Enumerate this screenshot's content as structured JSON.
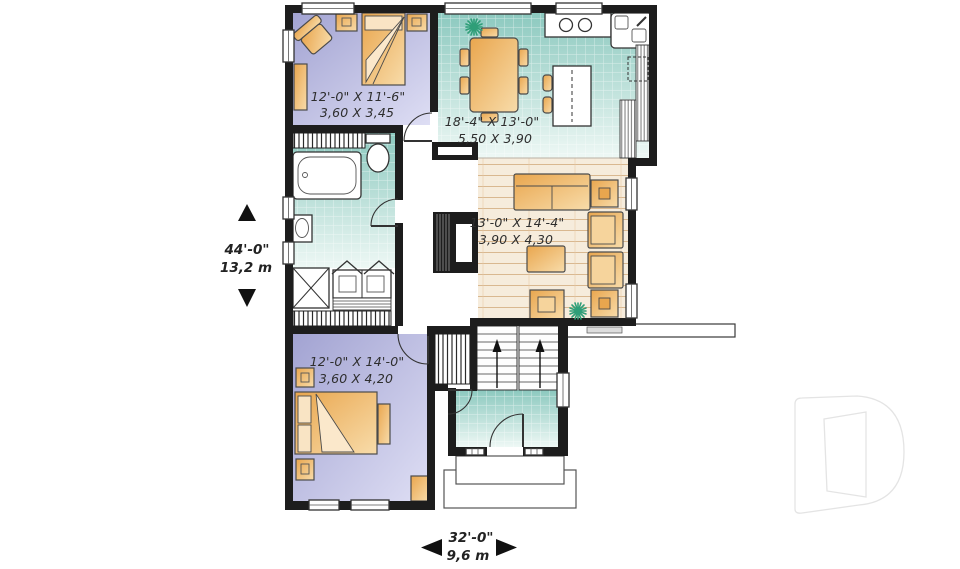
{
  "plan": {
    "rooms": [
      {
        "id": "bedroom-1",
        "imperial": "12'-0\" X 11'-6\"",
        "metric": "3,60 X 3,45"
      },
      {
        "id": "kitchen-dining",
        "imperial": "18'-4\" X 13'-0\"",
        "metric": "5,50 X 3,90"
      },
      {
        "id": "living-room",
        "imperial": "13'-0\" X 14'-4\"",
        "metric": "3,90 X 4,30"
      },
      {
        "id": "bedroom-2",
        "imperial": "12'-0\" X 14'-0\"",
        "metric": "3,60 X 4,20"
      }
    ],
    "overall_dimensions": {
      "depth_imperial": "44'-0\"",
      "depth_metric": "13,2 m",
      "width_imperial": "32'-0\"",
      "width_metric": "9,6 m"
    },
    "icons": {
      "plant": "plant-icon",
      "watermark": "d-logo-watermark",
      "stairs": "stairs-up-arrows"
    },
    "colors": {
      "wall": "#1d1d1d",
      "bedroom_floor_dark": "#a5a6d3",
      "bedroom_floor_light": "#dcdcf4",
      "tile_dark": "#8cc9bf",
      "tile_light": "#eef8f5",
      "wood_floor": "#f6ecdc",
      "wood_line": "#d9b890",
      "furniture_dark": "#e9a64e",
      "furniture_light": "#f8dcaa",
      "plant_green": "#2f9e78",
      "label_text": "#2e2e2e",
      "watermark_gray": "#e4e4e4"
    }
  }
}
